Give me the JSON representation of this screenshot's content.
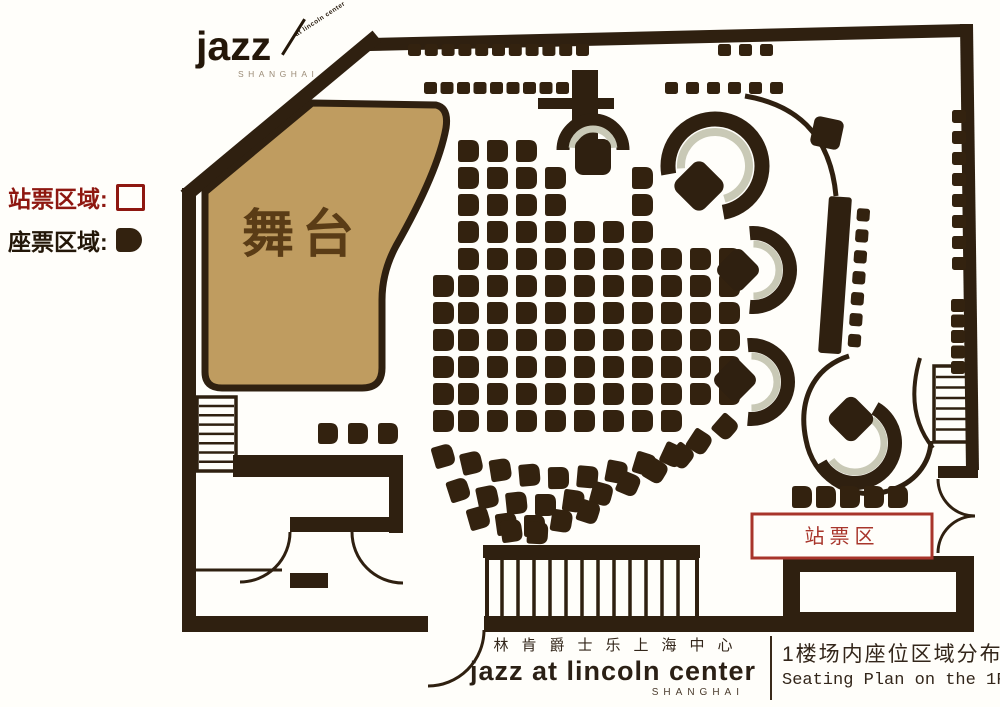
{
  "legend": {
    "standing": {
      "label": "站票区域:"
    },
    "seated": {
      "label": "座票区域:"
    }
  },
  "stage": {
    "label": "舞台"
  },
  "standing_area_box": {
    "label": "站票区"
  },
  "logo": {
    "word": "jazz",
    "tagline": "at lincoln center",
    "city": "SHANGHAI"
  },
  "footer": {
    "venue_cn": "林肯爵士乐上海中心",
    "venue_en": "jazz at lincoln center",
    "venue_city": "SHANGHAI",
    "plan_title_cn": "1楼场内座位区域分布",
    "plan_title_en": "Seating Plan on the 1F"
  },
  "colors": {
    "wall": "#2f2010",
    "stage_fill": "#bf9c60",
    "stage_text": "#5a3c16",
    "seat": "#33220f",
    "trim": "#c9c9b6",
    "legend_red": "#8e1710",
    "legend_dark": "#231708",
    "standing_box_red": "#a8352b",
    "text_dark": "#2b2015",
    "background": "#fffefa"
  }
}
